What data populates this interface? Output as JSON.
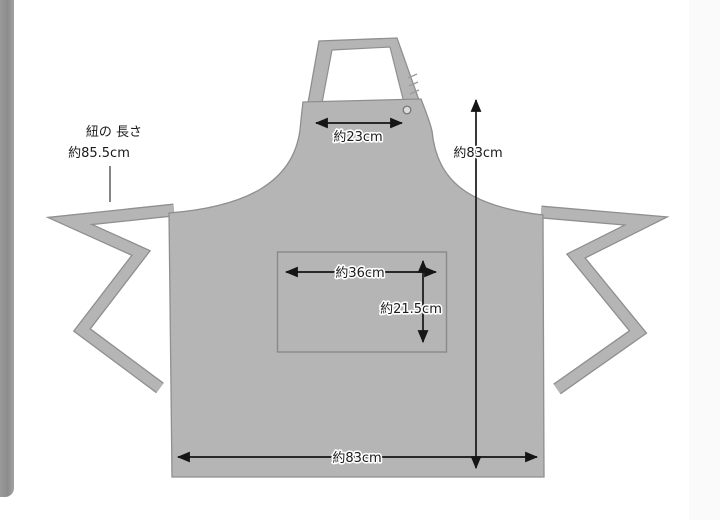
{
  "page": {
    "background_color": "#ffffff",
    "left_bar_color": "#909090",
    "right_strip_color": "#fafafa"
  },
  "diagram": {
    "subject": "apron dimension diagram",
    "apron_fill": "#b5b5b5",
    "apron_outline": "#8f8f8f",
    "arrow_color": "#151515",
    "labels": {
      "tie_length_title": "紐の 長さ",
      "tie_length_value": "約85.5cm",
      "neck_strap_width": "約23cm",
      "body_height": "約83cm",
      "pocket_width": "約36cm",
      "pocket_height": "約21.5cm",
      "bottom_width": "約83cm"
    },
    "measurements": [
      {
        "part": "waist-tie-length",
        "label": "約85.5cm",
        "value_cm": 85.5
      },
      {
        "part": "neck-strap-width",
        "label": "約23cm",
        "value_cm": 23
      },
      {
        "part": "apron-height",
        "label": "約83cm",
        "value_cm": 83
      },
      {
        "part": "pocket-width",
        "label": "約36cm",
        "value_cm": 36
      },
      {
        "part": "pocket-height",
        "label": "約21.5cm",
        "value_cm": 21.5
      },
      {
        "part": "apron-bottom-width",
        "label": "約83cm",
        "value_cm": 83
      }
    ]
  }
}
